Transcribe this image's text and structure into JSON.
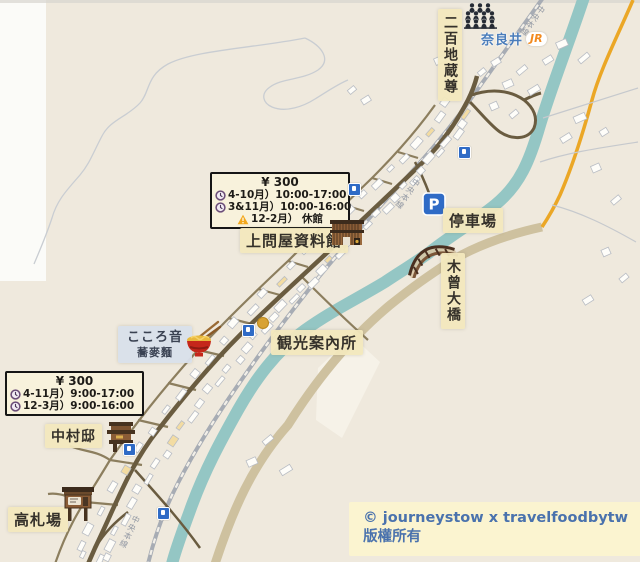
{
  "labels": {
    "jizo": "二百地蔵尊",
    "station": "奈良井",
    "jr": "JR",
    "parking": "停車場",
    "kiso_bridge": "木曾大橋",
    "kamidonya": "上問屋資料館",
    "tourist_info": "観光案內所",
    "kokorone": "こころ音",
    "kokorone_sub": "蕎麥麵",
    "nakamura": "中村邸",
    "kosatsuba": "高札場",
    "railway": "中央本線"
  },
  "info_boxes": {
    "kamidonya": {
      "price": "¥ 300",
      "hours": [
        {
          "icon": "clock",
          "text": "4-10月）10:00-17:00"
        },
        {
          "icon": "clock",
          "text": "3&11月）10:00-16:00"
        },
        {
          "icon": "warning",
          "text": "12-2月） 休館"
        }
      ]
    },
    "nakamura": {
      "price": "¥ 300",
      "hours": [
        {
          "icon": "clock",
          "text": "4-11月）9:00-17:00"
        },
        {
          "icon": "clock",
          "text": "12-3月）9:00-16:00"
        }
      ]
    }
  },
  "icons": {
    "parking_letter": "P"
  },
  "copyright": {
    "line1": "© journeystow x travelfoodbytw",
    "line2": "版權所有"
  },
  "colors": {
    "background": "#efe9dd",
    "river": "#94c6c4",
    "main_street": "#6a5c40",
    "secondary_road": "#8c7e5e",
    "bypass_road": "#cec19f",
    "highway": "#eba726",
    "railway": "#a7acb4",
    "label_bg": "#f3e8bd",
    "info_box_bg": "#f8f2dc",
    "marker_blue": "#2f6bc6",
    "station_text": "#4a7dbb",
    "jr_orange": "#f28a1e",
    "copyright_text": "#4a72ad"
  }
}
